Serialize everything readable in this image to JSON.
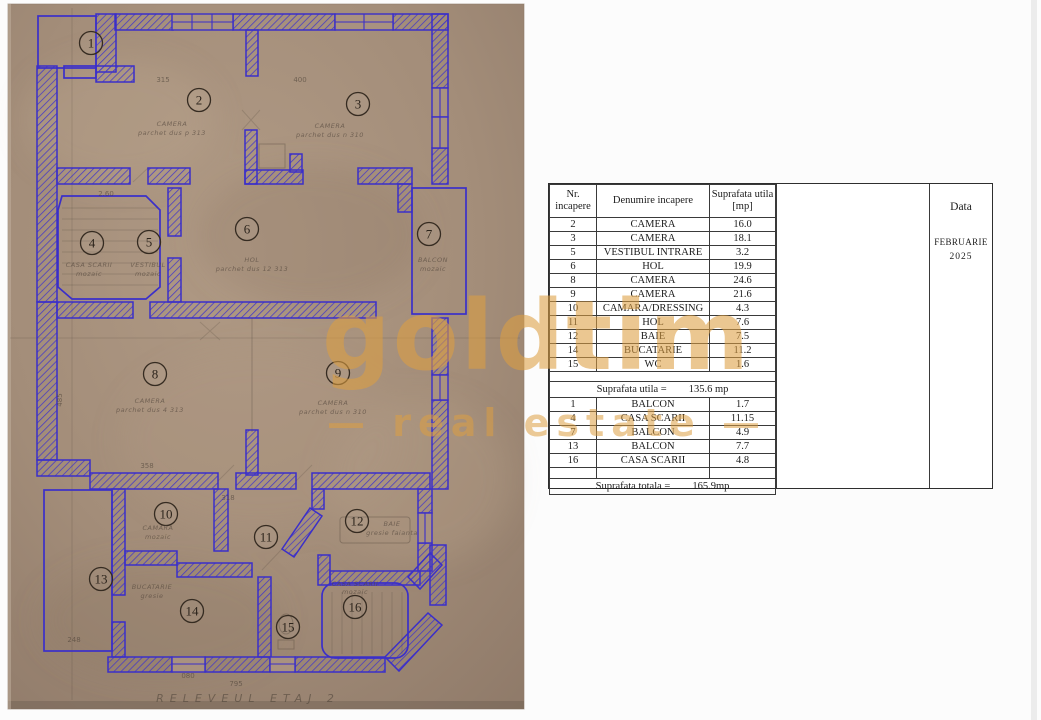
{
  "watermark": {
    "brand": "goldtim",
    "tagline": "— real estate —",
    "color": "#dd9e42"
  },
  "data_panel": {
    "title": "Data",
    "month": "FEBRUARIE",
    "year": "2025"
  },
  "table": {
    "header": {
      "nr1": "Nr.",
      "nr2": "incapere",
      "name": "Denumire incapere",
      "area1": "Suprafata utila",
      "area2": "[mp]"
    },
    "rows_main": [
      [
        "2",
        "CAMERA",
        "16.0"
      ],
      [
        "3",
        "CAMERA",
        "18.1"
      ],
      [
        "5",
        "VESTIBUL INTRARE",
        "3.2"
      ],
      [
        "6",
        "HOL",
        "19.9"
      ],
      [
        "8",
        "CAMERA",
        "24.6"
      ],
      [
        "9",
        "CAMERA",
        "21.6"
      ],
      [
        "10",
        "CAMARA/DRESSING",
        "4.3"
      ],
      [
        "11",
        "HOL",
        "7.6"
      ],
      [
        "12",
        "BAIE",
        "7.5"
      ],
      [
        "14",
        "BUCATARIE",
        "11.2"
      ],
      [
        "15",
        "WC",
        "1.6"
      ]
    ],
    "subtotal_label": "Suprafata utila =",
    "subtotal_value": "135.6 mp",
    "rows_annex": [
      [
        "1",
        "BALCON",
        "1.7"
      ],
      [
        "4",
        "CASA SCARII",
        "11.15"
      ],
      [
        "7",
        "BALCON",
        "4.9"
      ],
      [
        "13",
        "BALCON",
        "7.7"
      ],
      [
        "16",
        "CASA SCARII",
        "4.8"
      ]
    ],
    "total_label": "Suprafata totala =",
    "total_value": "165.9mp"
  },
  "floor_plan": {
    "ink_color": "#3b2fc9",
    "paper_color": "#a6907c",
    "caption": "RELEVEUL ETAJ 2",
    "rooms": [
      {
        "number": "1",
        "name": "BALCON"
      },
      {
        "number": "2",
        "name": "CAMERA",
        "pencil1": "CAMERA",
        "pencil2": "parchet dus p 313"
      },
      {
        "number": "3",
        "name": "CAMERA",
        "pencil1": "CAMERA",
        "pencil2": "parchet dus n 310"
      },
      {
        "number": "4",
        "name": "CASA SCARII",
        "pencil1": "CASA SCARII",
        "pencil2": "mozaic"
      },
      {
        "number": "5",
        "name": "VESTIBUL INTRARE",
        "pencil1": "VESTIBUL",
        "pencil2": "mozaic"
      },
      {
        "number": "6",
        "name": "HOL",
        "pencil1": "HOL",
        "pencil2": "parchet dus 12 313"
      },
      {
        "number": "7",
        "name": "BALCON",
        "pencil1": "BALCON",
        "pencil2": "mozaic"
      },
      {
        "number": "8",
        "name": "CAMERA",
        "pencil1": "CAMERA",
        "pencil2": "parchet dus 4 313"
      },
      {
        "number": "9",
        "name": "CAMERA",
        "pencil1": "CAMERA",
        "pencil2": "parchet dus n 310"
      },
      {
        "number": "10",
        "name": "CAMARA/DRESSING",
        "pencil1": "CAMARA",
        "pencil2": "mozaic"
      },
      {
        "number": "11",
        "name": "HOL"
      },
      {
        "number": "12",
        "name": "BAIE",
        "pencil1": "BAIE",
        "pencil2": "gresie faianta"
      },
      {
        "number": "13",
        "name": "BALCON"
      },
      {
        "number": "14",
        "name": "BUCATARIE",
        "pencil1": "BUCATARIE",
        "pencil2": "gresie"
      },
      {
        "number": "15",
        "name": "WC"
      },
      {
        "number": "16",
        "name": "CASA SCARII",
        "pencil1": "CASA SCARII",
        "pencil2": "mozaic"
      }
    ],
    "dims": [
      "315",
      "400",
      "2.60",
      "485",
      "358",
      "318",
      "248",
      "795",
      "080"
    ]
  }
}
